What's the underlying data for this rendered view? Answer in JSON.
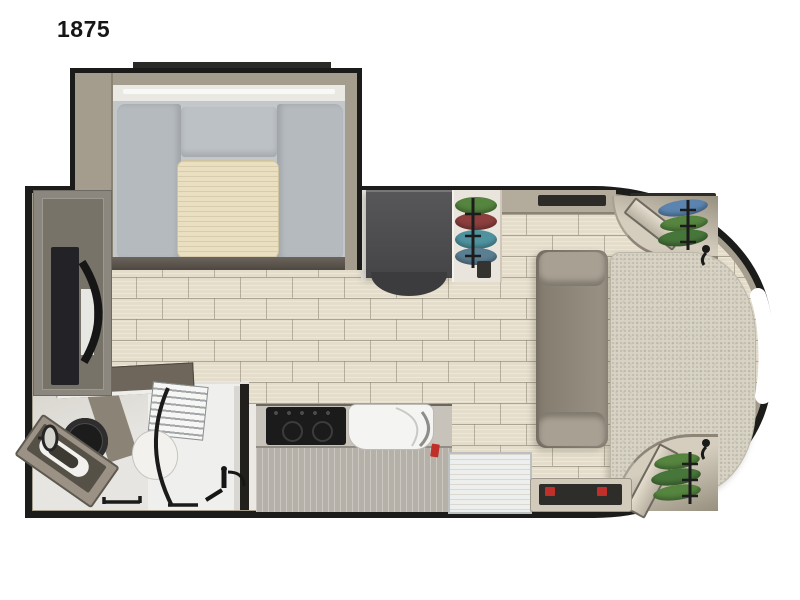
{
  "page": {
    "background_color": "#ffffff"
  },
  "plan": {
    "model_label": "1875",
    "subject": "travel trailer floor plan, top-down view, curved front cap on right",
    "colors": {
      "outline_black": "#1c1c1a",
      "wall_tan": "#a59d8e",
      "floor_plank": "#e4ddcc",
      "floor_grout": "#8c8474",
      "dinette_cushion_gray": "#b5babe",
      "dinette_table_cream": "#eadfc0",
      "sofa_taupe": "#8f887b",
      "bed_beige": "#d8d3c5",
      "refrigerator_dark": "#47474a",
      "cooktop_black": "#1b1b1b",
      "sink_white": "#f4f4f2",
      "clothes_green": "#55853f",
      "clothes_maroon": "#8c3f3d",
      "clothes_teal": "#4f93a0",
      "clothes_blue": "#5b85b0",
      "accent_red": "#c0302a"
    },
    "features": [
      "front-bed",
      "corner-wardrobe-top",
      "corner-wardrobe-bottom",
      "sofa",
      "dinette-slide-out",
      "dinette-table",
      "refrigerator",
      "hanging-wardrobe",
      "overhead-cabinet",
      "kitchen-counter",
      "cooktop",
      "kitchen-sink",
      "entry-landing",
      "entry-step-mat",
      "tv-cabinet",
      "bathroom",
      "toilet",
      "vanity-sink",
      "corner-shower",
      "shower-shelves",
      "reading-lights",
      "window"
    ]
  }
}
